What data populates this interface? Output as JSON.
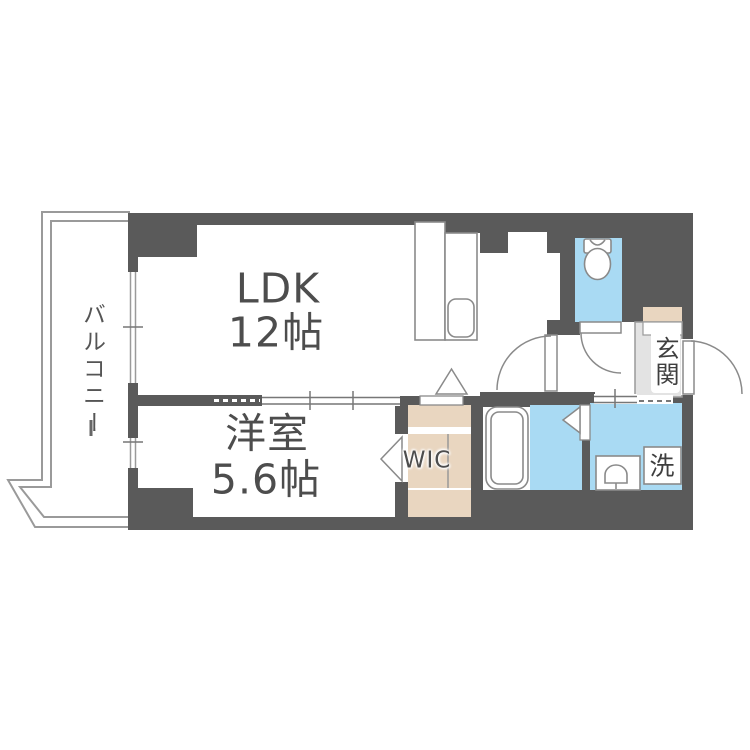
{
  "labels": {
    "balcony": "バルコニー",
    "ldk_name": "LDK",
    "ldk_size": "12帖",
    "bedroom_name": "洋室",
    "bedroom_size": "5.6帖",
    "wic": "WIC",
    "entrance": "玄関",
    "laundry": "洗"
  },
  "colors": {
    "wall": "#5a5a5a",
    "water_floor": "#a9daf3",
    "wood_floor": "#e9d6c0",
    "entrance_floor": "#e3e3e3",
    "fixture_outline": "#8a8a8a",
    "balcony_line": "#9a9a9a",
    "text": "#4d4d4d",
    "background": "#ffffff"
  },
  "fixtures": [
    "kitchen-counter",
    "kitchen-sink",
    "toilet",
    "bathtub",
    "wash-basin",
    "washing-machine-space",
    "entrance-step",
    "sliding-door",
    "hinged-door",
    "folding-door",
    "window"
  ]
}
